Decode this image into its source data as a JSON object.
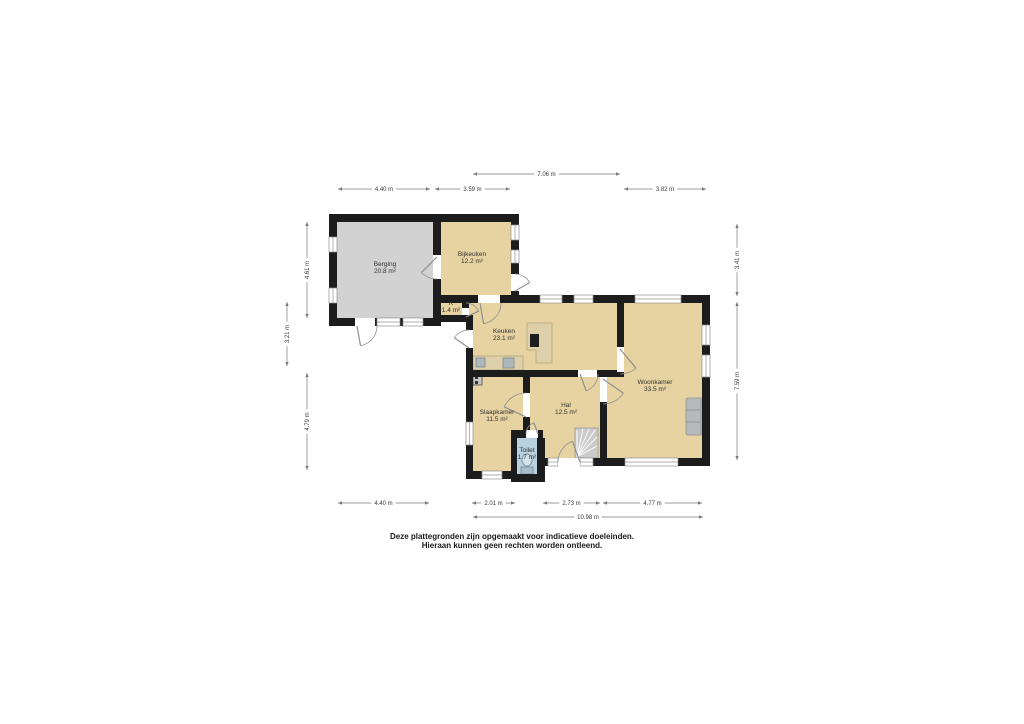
{
  "disclaimer": {
    "line1": "Deze plattegronden zijn opgemaakt voor indicatieve doeleinden.",
    "line2": "Hieraan kunnen geen rechten worden ontleend."
  },
  "plan": {
    "colors": {
      "wall": "#1C1C1C",
      "floor_tan": "#E6D3A1",
      "floor_gray": "#D2D2D2",
      "floor_blue": "#B8D1DF",
      "window_line": "#909090",
      "door_line": "#8F8F8F",
      "dim_line": "#7A7A7A",
      "dim_text": "#3A3A3A"
    },
    "rooms": [
      {
        "id": "berging",
        "name": "Berging",
        "area": "20.8 m²",
        "x": 337,
        "y": 222,
        "w": 96,
        "h": 96,
        "floor": "#D2D2D2",
        "lx": 385,
        "ly": 266
      },
      {
        "id": "bijkeuken",
        "name": "Bijkeuken",
        "area": "12.2 m²",
        "x": 441,
        "y": 222,
        "w": 70,
        "h": 73,
        "floor": "#E6D3A1",
        "lx": 472,
        "ly": 256
      },
      {
        "id": "k",
        "name": "K",
        "area": "1.4 m²",
        "x": 441,
        "y": 300,
        "w": 21,
        "h": 16,
        "floor": "#E6D3A1",
        "lx": 451,
        "ly": 305
      },
      {
        "id": "keuken",
        "name": "Keuken",
        "area": "23.1 m²",
        "x": 469,
        "y": 303,
        "w": 148,
        "h": 67,
        "floor": "#E6D3A1",
        "lx": 504,
        "ly": 333
      },
      {
        "id": "woonkamer",
        "name": "Woonkamer",
        "area": "33.5 m²",
        "x": 607,
        "y": 303,
        "w": 95,
        "h": 155,
        "floor": "#E6D3A1",
        "lx": 655,
        "ly": 384
      },
      {
        "id": "hal",
        "name": "Hal",
        "area": "12.5 m²",
        "x": 530,
        "y": 377,
        "w": 70,
        "h": 81,
        "floor": "#E6D3A1",
        "lx": 566,
        "ly": 407
      },
      {
        "id": "slaapkamer",
        "name": "Slaapkamer",
        "area": "11.5 m²",
        "x": 473,
        "y": 377,
        "w": 50,
        "h": 94,
        "floor": "#E6D3A1",
        "lx": 497,
        "ly": 414
      },
      {
        "id": "toilet",
        "name": "Toilet",
        "area": "1.7 m²",
        "x": 517,
        "y": 438,
        "w": 20,
        "h": 36,
        "floor": "#B8D1DF",
        "lx": 527,
        "ly": 452
      }
    ],
    "walls": [
      [
        329,
        214,
        190,
        8
      ],
      [
        329,
        214,
        8,
        23
      ],
      [
        329,
        252,
        8,
        36
      ],
      [
        329,
        303,
        8,
        23
      ],
      [
        329,
        318,
        26,
        8
      ],
      [
        375,
        318,
        2,
        8
      ],
      [
        400,
        318,
        3,
        8
      ],
      [
        423,
        318,
        18,
        8
      ],
      [
        433,
        214,
        8,
        41
      ],
      [
        433,
        279,
        8,
        46
      ],
      [
        511,
        214,
        8,
        11
      ],
      [
        511,
        240,
        8,
        10
      ],
      [
        511,
        263,
        8,
        11
      ],
      [
        511,
        291,
        8,
        12
      ],
      [
        433,
        315,
        40,
        7
      ],
      [
        462,
        300,
        7,
        8
      ],
      [
        441,
        295,
        37,
        8
      ],
      [
        500,
        295,
        40,
        8
      ],
      [
        562,
        295,
        12,
        8
      ],
      [
        593,
        295,
        42,
        8
      ],
      [
        681,
        295,
        29,
        8
      ],
      [
        466,
        315,
        7,
        15
      ],
      [
        466,
        348,
        7,
        74
      ],
      [
        466,
        445,
        7,
        34
      ],
      [
        702,
        295,
        8,
        30
      ],
      [
        702,
        345,
        8,
        10
      ],
      [
        702,
        377,
        8,
        89
      ],
      [
        543,
        458,
        5,
        8
      ],
      [
        593,
        458,
        32,
        8
      ],
      [
        678,
        458,
        32,
        8
      ],
      [
        466,
        471,
        16,
        8
      ],
      [
        502,
        471,
        15,
        8
      ],
      [
        511,
        474,
        34,
        8
      ],
      [
        537,
        438,
        8,
        41
      ],
      [
        511,
        430,
        15,
        8
      ],
      [
        538,
        430,
        5,
        8
      ],
      [
        511,
        430,
        6,
        49
      ],
      [
        617,
        303,
        7,
        44
      ],
      [
        473,
        370,
        105,
        7
      ],
      [
        597,
        370,
        27,
        7
      ],
      [
        600,
        402,
        7,
        64
      ],
      [
        523,
        377,
        7,
        16
      ],
      [
        523,
        417,
        7,
        13
      ]
    ],
    "windows": [
      [
        329,
        237,
        8,
        15,
        "v"
      ],
      [
        329,
        288,
        8,
        15,
        "v"
      ],
      [
        377,
        318,
        23,
        8,
        "h"
      ],
      [
        403,
        318,
        20,
        8,
        "h"
      ],
      [
        511,
        225,
        8,
        15,
        "v"
      ],
      [
        511,
        250,
        8,
        13,
        "v"
      ],
      [
        540,
        295,
        22,
        8,
        "h"
      ],
      [
        574,
        295,
        19,
        8,
        "h"
      ],
      [
        635,
        295,
        46,
        8,
        "h"
      ],
      [
        702,
        325,
        8,
        20,
        "v"
      ],
      [
        702,
        355,
        8,
        22,
        "v"
      ],
      [
        625,
        458,
        53,
        8,
        "h"
      ],
      [
        548,
        458,
        10,
        8,
        "h"
      ],
      [
        580,
        458,
        13,
        8,
        "h"
      ],
      [
        482,
        471,
        20,
        8,
        "h"
      ],
      [
        466,
        422,
        7,
        23,
        "v"
      ]
    ],
    "doors": [
      {
        "id": "berging-buitendeur",
        "op": [
          355,
          318,
          20,
          8
        ],
        "h": [
          357,
          326
        ],
        "r": 20,
        "a0": 0,
        "a1": 80
      },
      {
        "id": "berging-bijkeuken-deur",
        "op": [
          433,
          255,
          8,
          24
        ],
        "h": [
          437,
          257
        ],
        "r": 22,
        "a0": 90,
        "a1": 135
      },
      {
        "id": "bijkeuken-buitendeur",
        "op": [
          511,
          274,
          8,
          17
        ],
        "h": [
          515,
          291
        ],
        "r": 17,
        "a0": -90,
        "a1": -30
      },
      {
        "id": "bijkeuken-keuken-deur",
        "op": [
          478,
          295,
          22,
          8
        ],
        "h": [
          480,
          303
        ],
        "r": 21,
        "a0": 0,
        "a1": 80
      },
      {
        "id": "kast-deur",
        "h": [
          466,
          317
        ],
        "r": 14,
        "a0": -90,
        "a1": -25
      },
      {
        "id": "keuken-buitendeur",
        "op": [
          466,
          330,
          7,
          18
        ],
        "h": [
          469,
          348
        ],
        "r": 18,
        "a0": -90,
        "a1": -145
      },
      {
        "id": "keuken-woonkamer-deur",
        "op": [
          617,
          347,
          7,
          25
        ],
        "h": [
          620,
          349
        ],
        "r": 25,
        "a0": 90,
        "a1": 50
      },
      {
        "id": "keuken-hal-deur",
        "op": [
          578,
          370,
          19,
          7
        ],
        "h": [
          580,
          374
        ],
        "r": 18,
        "a0": 0,
        "a1": 70
      },
      {
        "id": "hal-woonkamer-deur",
        "op": [
          600,
          377,
          7,
          25
        ],
        "h": [
          603,
          379
        ],
        "r": 25,
        "a0": 90,
        "a1": 35
      },
      {
        "id": "hal-slaapkamer-deur",
        "op": [
          523,
          393,
          7,
          24
        ],
        "h": [
          526,
          417
        ],
        "r": 24,
        "a0": -90,
        "a1": -155
      },
      {
        "id": "hal-toilet-deur",
        "op": [
          526,
          430,
          12,
          8
        ],
        "h": [
          538,
          434
        ],
        "r": 12,
        "a0": 180,
        "a1": 250
      },
      {
        "id": "voordeur",
        "op": [
          558,
          458,
          22,
          8
        ],
        "h": [
          580,
          462
        ],
        "r": 22,
        "a0": 180,
        "a1": 250
      }
    ],
    "fixtures": [
      {
        "kind": "rect",
        "name": "kitchen-counter",
        "x": 473,
        "y": 356,
        "w": 50,
        "h": 14,
        "fill": "#DDD0AB",
        "stroke": "#B3A67C"
      },
      {
        "kind": "rect",
        "name": "kitchen-sink",
        "x": 476,
        "y": 358,
        "w": 9,
        "h": 9,
        "fill": "#AEB7BD",
        "stroke": "#7B868D"
      },
      {
        "kind": "rect",
        "name": "kitchen-appliance",
        "x": 503,
        "y": 358,
        "w": 11,
        "h": 10,
        "fill": "#AEB7BD",
        "stroke": "#7B868D"
      },
      {
        "kind": "poly",
        "name": "kitchen-island",
        "points": "527,323 552,323 552,363 536,363 536,350 527,350",
        "fill": "#DDD0AB",
        "stroke": "#B3A67C"
      },
      {
        "kind": "rect",
        "name": "cooktop",
        "x": 530,
        "y": 334,
        "w": 9,
        "h": 13,
        "fill": "#1E1E1E"
      },
      {
        "kind": "rect",
        "name": "stairs",
        "x": 575,
        "y": 428,
        "w": 23,
        "h": 30,
        "fill": "#CBCBCB",
        "stroke": "#9B9B9B"
      },
      {
        "kind": "line",
        "name": "stair-tread",
        "x1": 577,
        "y1": 457,
        "x2": 577,
        "y2": 430,
        "stroke": "#FFFFFF"
      },
      {
        "kind": "line",
        "name": "stair-tread",
        "x1": 577,
        "y1": 457,
        "x2": 583,
        "y2": 429,
        "stroke": "#FFFFFF"
      },
      {
        "kind": "line",
        "name": "stair-tread",
        "x1": 577,
        "y1": 457,
        "x2": 589,
        "y2": 429,
        "stroke": "#FFFFFF"
      },
      {
        "kind": "line",
        "name": "stair-tread",
        "x1": 577,
        "y1": 457,
        "x2": 595,
        "y2": 430,
        "stroke": "#FFFFFF"
      },
      {
        "kind": "line",
        "name": "stair-tread",
        "x1": 577,
        "y1": 457,
        "x2": 597,
        "y2": 437,
        "stroke": "#FFFFFF"
      },
      {
        "kind": "line",
        "name": "stair-tread",
        "x1": 577,
        "y1": 457,
        "x2": 597,
        "y2": 446,
        "stroke": "#FFFFFF"
      },
      {
        "kind": "rect",
        "name": "sofa",
        "x": 686,
        "y": 398,
        "w": 21,
        "h": 37,
        "rx": 2,
        "fill": "#B7B9BB",
        "stroke": "#8E9092"
      },
      {
        "kind": "rect",
        "name": "sofa-back",
        "x": 700,
        "y": 399,
        "w": 6,
        "h": 35,
        "fill": "#A6A8AA"
      },
      {
        "kind": "line",
        "name": "sofa-seam",
        "x1": 687,
        "y1": 410,
        "x2": 700,
        "y2": 410,
        "stroke": "#8E9092"
      },
      {
        "kind": "line",
        "name": "sofa-seam",
        "x1": 687,
        "y1": 422,
        "x2": 700,
        "y2": 422,
        "stroke": "#8E9092"
      },
      {
        "kind": "rect",
        "name": "toilet-tank",
        "x": 521,
        "y": 467,
        "w": 12,
        "h": 7,
        "fill": "#A6BDCB",
        "stroke": "#6F8694"
      },
      {
        "kind": "ellipse",
        "name": "toilet-bowl",
        "cx": 527,
        "cy": 460,
        "rx": 5,
        "ry": 6,
        "fill": "#D5E2EA",
        "stroke": "#6F8694"
      },
      {
        "kind": "rect",
        "name": "meter-box",
        "x": 473,
        "y": 374,
        "w": 9,
        "h": 11,
        "fill": "#C6C6C6",
        "stroke": "#4A4A4A"
      },
      {
        "kind": "rect",
        "name": "meter-box-detail",
        "x": 475,
        "y": 376,
        "w": 3,
        "h": 3,
        "fill": "#333333"
      },
      {
        "kind": "rect",
        "name": "meter-box-detail",
        "x": 475,
        "y": 381,
        "w": 3,
        "h": 3,
        "fill": "#333333"
      }
    ],
    "dims_h": [
      {
        "label": "7.06 m",
        "x1": 473,
        "x2": 620,
        "y": 174
      },
      {
        "label": "4.40 m",
        "x1": 338,
        "x2": 430,
        "y": 189
      },
      {
        "label": "3.59 m",
        "x1": 435,
        "x2": 510,
        "y": 189
      },
      {
        "label": "3.82 m",
        "x1": 624,
        "x2": 706,
        "y": 189
      },
      {
        "label": "4.40 m",
        "x1": 338,
        "x2": 429,
        "y": 503
      },
      {
        "label": "2.01 m",
        "x1": 472,
        "x2": 515,
        "y": 503
      },
      {
        "label": "2.73 m",
        "x1": 543,
        "x2": 600,
        "y": 503
      },
      {
        "label": "4.77 m",
        "x1": 603,
        "x2": 702,
        "y": 503
      },
      {
        "label": "10.98 m",
        "x1": 473,
        "x2": 703,
        "y": 517
      }
    ],
    "dims_v": [
      {
        "label": "4.61 m",
        "x": 307,
        "y1": 222,
        "y2": 318
      },
      {
        "label": "3.21 m",
        "x": 287,
        "y1": 302,
        "y2": 366
      },
      {
        "label": "4.79 m",
        "x": 307,
        "y1": 373,
        "y2": 470
      },
      {
        "label": "3.41 m",
        "x": 737,
        "y1": 224,
        "y2": 296
      },
      {
        "label": "7.59 m",
        "x": 737,
        "y1": 302,
        "y2": 460
      }
    ]
  }
}
